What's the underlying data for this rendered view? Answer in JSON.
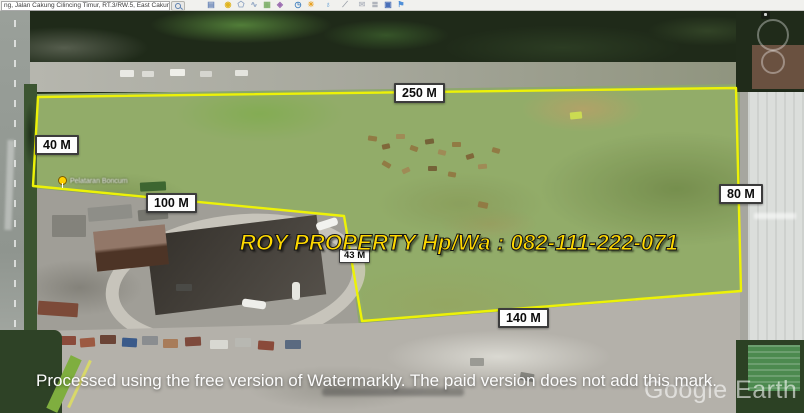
{
  "window": {
    "app": "Google Earth Pro",
    "search_value": "ng, Jalan Cakung Cilincing Timur, RT.3/RW.5, East Cakung, East Jakarta City, Jakarta",
    "search_button_icon": "magnifier-icon"
  },
  "toolbar": {
    "icons": [
      {
        "name": "hide-sidebar",
        "glyph": "▤",
        "color": "#6c87b8"
      },
      {
        "name": "add-placemark",
        "glyph": "◉",
        "color": "#e0b420"
      },
      {
        "name": "add-polygon",
        "glyph": "⬠",
        "color": "#8aa0c0"
      },
      {
        "name": "add-path",
        "glyph": "∿",
        "color": "#8aa0c0"
      },
      {
        "name": "add-image-overlay",
        "glyph": "▦",
        "color": "#7fb06a"
      },
      {
        "name": "record-tour",
        "glyph": "◈",
        "color": "#9a6ab0"
      },
      {
        "name": "historical-imagery",
        "glyph": "◷",
        "color": "#3f7fbf"
      },
      {
        "name": "sunlight",
        "glyph": "☀",
        "color": "#e8a020"
      },
      {
        "name": "planets",
        "glyph": "♁",
        "color": "#4a90d0"
      },
      {
        "name": "ruler",
        "glyph": "⟋",
        "color": "#9aa0a8"
      },
      {
        "name": "email",
        "glyph": "✉",
        "color": "#b8bcc4"
      },
      {
        "name": "print",
        "glyph": "≣",
        "color": "#8a92a0"
      },
      {
        "name": "save-image",
        "glyph": "▣",
        "color": "#4a70b8"
      },
      {
        "name": "view-in-google-maps",
        "glyph": "⚑",
        "color": "#5090d8"
      }
    ]
  },
  "map": {
    "measurements": {
      "top": "250 M",
      "left": "40 M",
      "inner": "100 M",
      "notch": "43 M",
      "bottom": "140 M",
      "right": "80 M"
    },
    "placemark_label": "Pelataran Boncum",
    "ad_watermark": "ROY PROPERTY Hp/Wa : 082-111-222-071",
    "processing_watermark": "Processed using the free version of Watermarkly. The paid version does not add this mark.",
    "logo_text": "Google Earth",
    "colors": {
      "boundary_yellow": "#edf207",
      "ad_text_yellow": "#ffd900",
      "label_background": "#fdfdfd",
      "label_text": "#0b0b0b",
      "field_green": "#8ea76f"
    }
  }
}
